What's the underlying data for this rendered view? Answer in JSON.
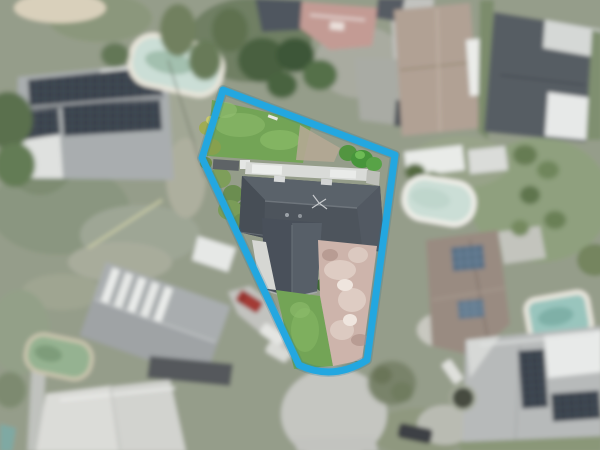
{
  "scene": {
    "type": "aerial-photo",
    "description": "Aerial drone photograph of a suburban cul-de-sac neighbourhood with one irregular wedge-shaped property lot outlined in blue"
  },
  "boundary": {
    "color": "#23A7E0",
    "shadow_color": "#15719C",
    "stroke_width": 7,
    "path": "M223,90 L202,158 L299,365 Q333,381 367,360 L395,155 Z"
  },
  "palette": {
    "grass_base": "#959D8A",
    "lawn": "#73A456",
    "road": "#C5C6C1",
    "roof_dark": "#4D545C",
    "roof_light": "#A9ADAF",
    "pavers": "#CDB4AB",
    "pool_water": "#CBDED6",
    "pool_teal": "#99C5BD",
    "pool_green": "#95B291",
    "solar": "#39404A",
    "tan_roof": "#B1A194",
    "tree_dark": "#49603F"
  },
  "features": [
    "outlined wedge-shaped property lot",
    "dark hip-roof dwelling with antenna",
    "white pergola roof behind dwelling",
    "pink paver driveway to cul-de-sac",
    "bright front and back lawns",
    "cul-de-sac turning circle",
    "neighbour houses with rooftop solar arrays",
    "backyard swimming pools",
    "parked cars",
    "dense garden trees and hedges"
  ]
}
